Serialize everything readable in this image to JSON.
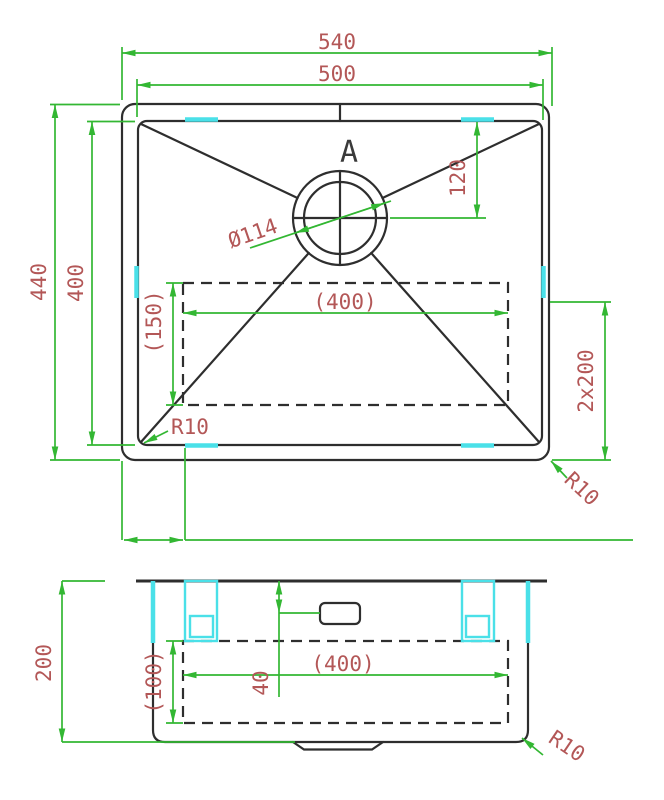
{
  "colors": {
    "dimension": "#33b733",
    "annotation": "#b35757",
    "outline": "#2e2e2e",
    "clip_highlight": "#4ae0e8",
    "background": "#ffffff"
  },
  "top_view": {
    "overall_width": "540",
    "bowl_width": "500",
    "overall_depth": "440",
    "bowl_depth": "400",
    "drain_center_offset": "120",
    "drain_diameter": "Ø114",
    "base_width_ref": "(400)",
    "base_depth_ref": "(150)",
    "clip_pitch": "2x200",
    "bowl_corner_radius": "R10",
    "outer_corner_radius": "R10",
    "section_label": "A"
  },
  "side_view": {
    "overall_height": "200",
    "base_width_ref": "(400)",
    "base_height_ref": "(100)",
    "overflow_offset": "40",
    "corner_radius": "R10"
  }
}
